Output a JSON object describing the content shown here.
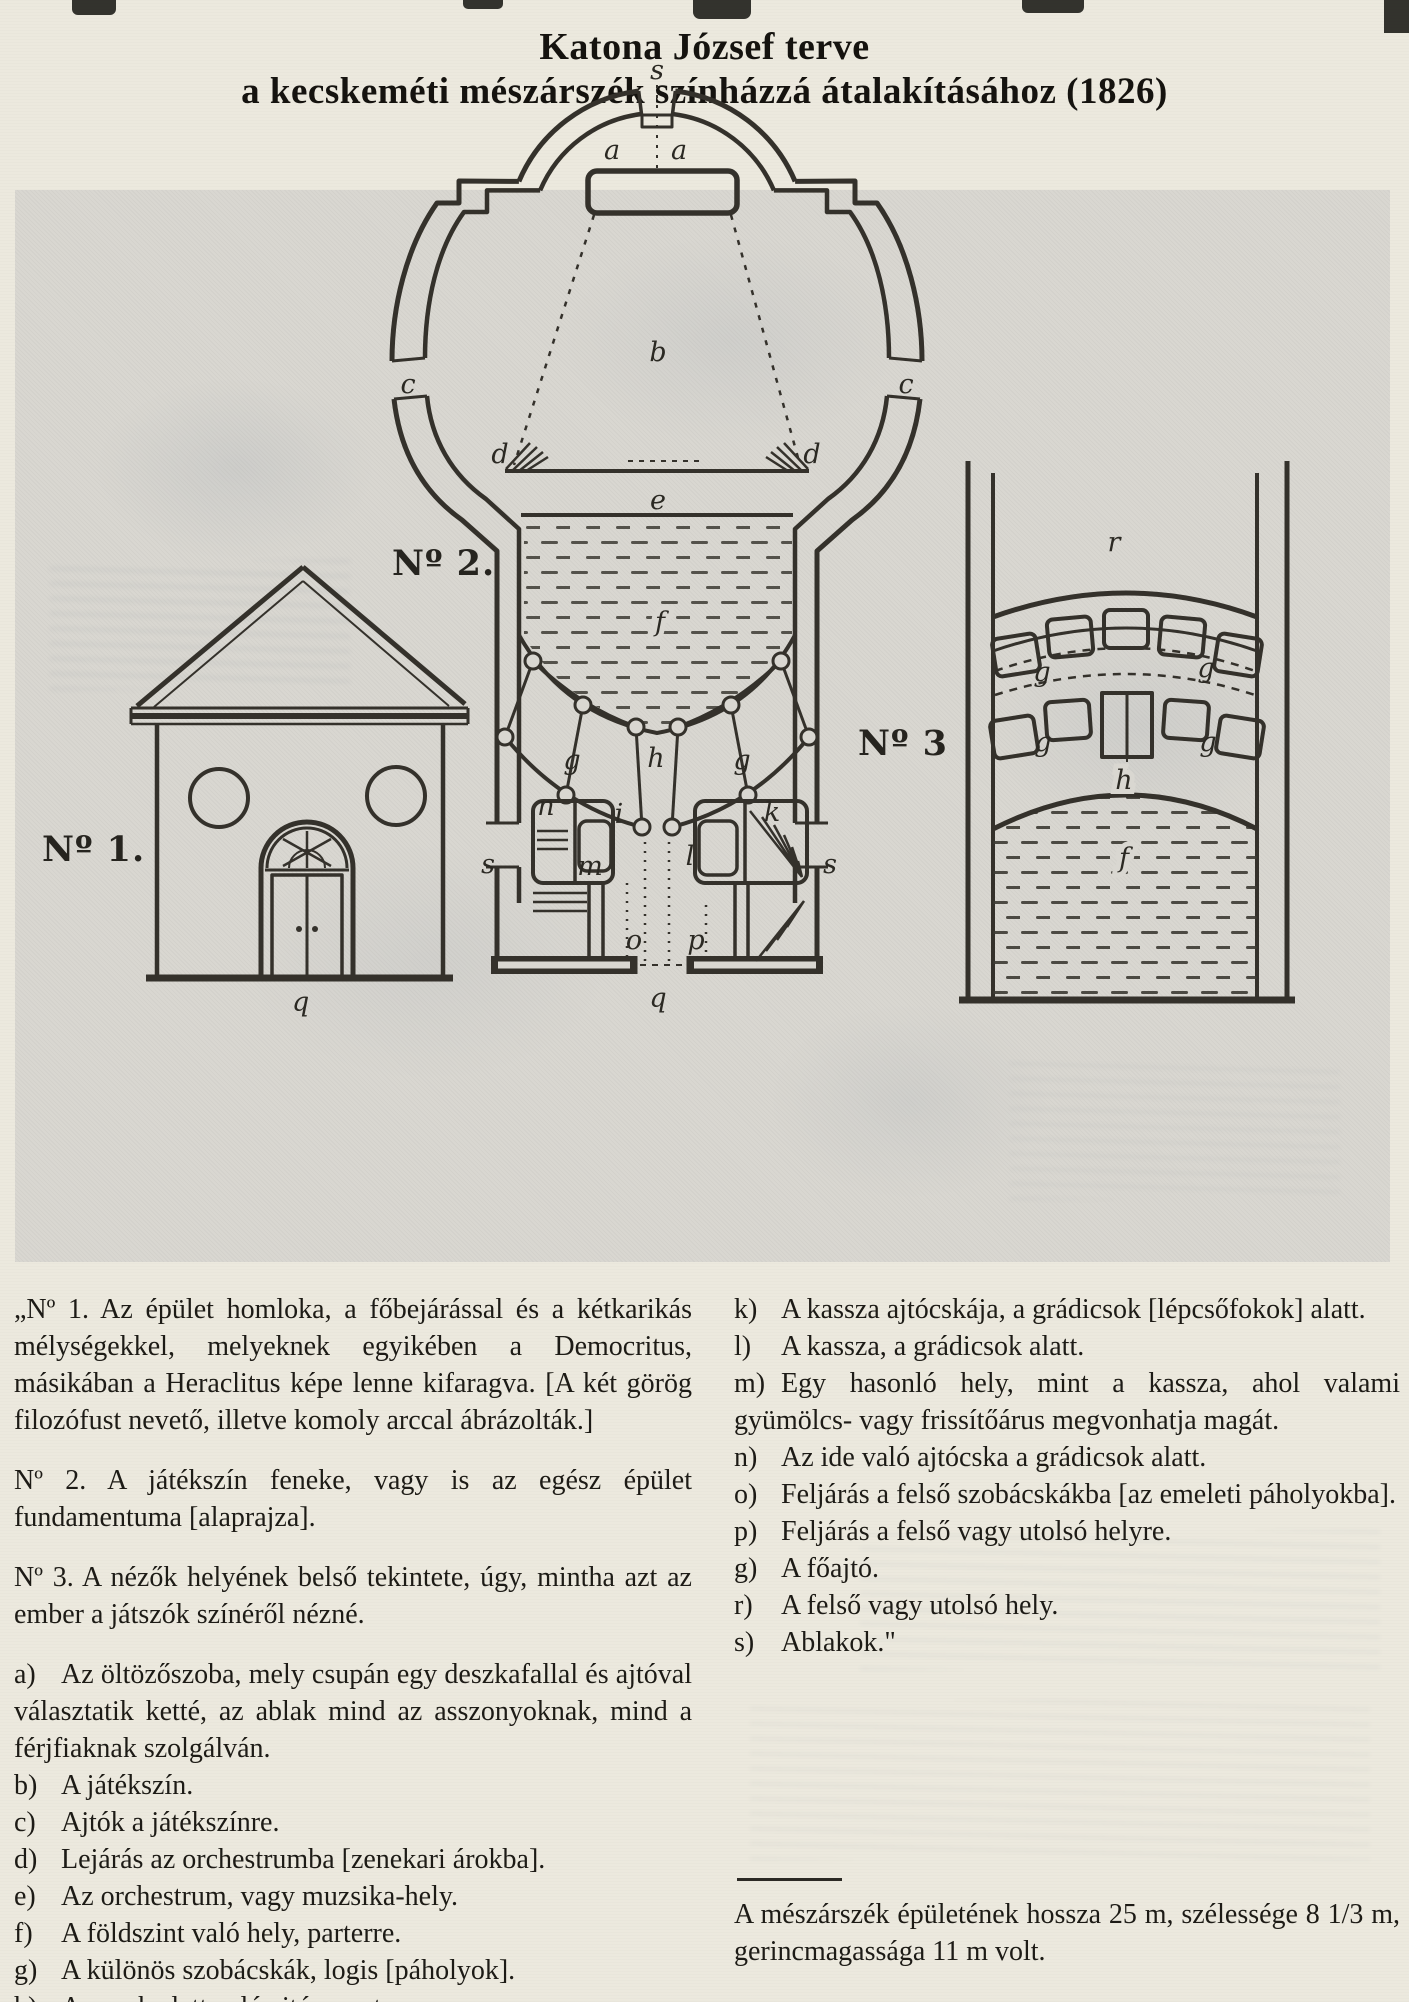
{
  "title": {
    "line1": "Katona József terve",
    "line2": "a kecskeméti mészárszék színházzá átalakításához (1826)"
  },
  "figure": {
    "no1": {
      "label": "Nº 1.",
      "marks": {
        "q": "q"
      }
    },
    "no2": {
      "label": "Nº 2.",
      "marks": {
        "s_top": "s",
        "a_left": "a",
        "a_right": "a",
        "b": "b",
        "c_left": "c",
        "c_right": "c",
        "d_left": "d",
        "d_right": "d",
        "e": "e",
        "f": "f",
        "g_left": "g",
        "g_right": "g",
        "h": "h",
        "n": "n",
        "i": "i",
        "k": "k",
        "m": "m",
        "l": "l",
        "s_door_left": "s",
        "s_door_right": "s",
        "o": "o",
        "p": "p",
        "q": "q"
      }
    },
    "no3": {
      "label": "Nº 3",
      "marks": {
        "r": "r",
        "g_upper_left": "g",
        "g_upper_right": "g",
        "g_lower_left": "g",
        "g_lower_right": "g",
        "h": "h",
        "f": "f"
      }
    }
  },
  "legend": {
    "left": {
      "paragraphs": [
        "„Nº 1. Az épület homloka, a főbejárással és a kétkarikás mélységekkel, melyeknek egyikében a Democritus, másikában a Heraclitus képe lenne kifaragva. [A két görög filozófust nevető, illetve komoly arccal ábrázolták.]",
        "Nº 2. A játékszín feneke, vagy is az egész épület fundamentuma [alaprajza].",
        "Nº 3. A nézők helyének belső tekintete, úgy, mintha azt az ember a játszók színéről nézné."
      ],
      "items": [
        {
          "key": "a)",
          "text": "Az öltözőszoba, mely csupán egy deszkafallal és ajtóval választatik ketté, az ablak mind az asszonyoknak, mind a férjfiaknak szolgálván."
        },
        {
          "key": "b)",
          "text": "A játékszín."
        },
        {
          "key": "c)",
          "text": "Ajtók a játékszínre."
        },
        {
          "key": "d)",
          "text": "Lejárás az orchestrumba [zenekari árokba]."
        },
        {
          "key": "e)",
          "text": "Az orchestrum, vagy muzsika-hely."
        },
        {
          "key": "f)",
          "text": "A földszint való hely, parterre."
        },
        {
          "key": "g)",
          "text": "A különös szobácskák, logis [páholyok]."
        },
        {
          "key": "h)",
          "text": "Az ezek alatt való ajtó a parterre."
        },
        {
          "key": "i)",
          "text": "Bejárás az alsó szobácskákba [a földszinti páholyokba]."
        }
      ]
    },
    "right": {
      "items": [
        {
          "key": "k)",
          "text": "A kassza ajtócskája, a grádicsok [lépcsőfokok] alatt."
        },
        {
          "key": "l)",
          "text": "A kassza, a grádicsok alatt."
        },
        {
          "key": "m)",
          "text": "Egy hasonló hely, mint a kassza, ahol valami gyümölcs- vagy frissítőárus megvonhatja magát."
        },
        {
          "key": "n)",
          "text": "Az ide való ajtócska a grádicsok alatt."
        },
        {
          "key": "o)",
          "text": "Feljárás a felső szobácskákba [az emeleti páholyokba]."
        },
        {
          "key": "p)",
          "text": "Feljárás a felső vagy utolsó helyre."
        },
        {
          "key": "g)",
          "text": "A főajtó."
        },
        {
          "key": "r)",
          "text": "A felső vagy utolsó hely."
        },
        {
          "key": "s)",
          "text": "Ablakok.\""
        }
      ],
      "closing": "A mészárszék épületének hossza 25 m, szélessége 8 1/3 m, gerincmagassága 11 m volt."
    }
  },
  "colors": {
    "paper": "#ece9de",
    "panel": "#d9d7d1",
    "ink": "#34312b",
    "text": "#1d1b16"
  }
}
